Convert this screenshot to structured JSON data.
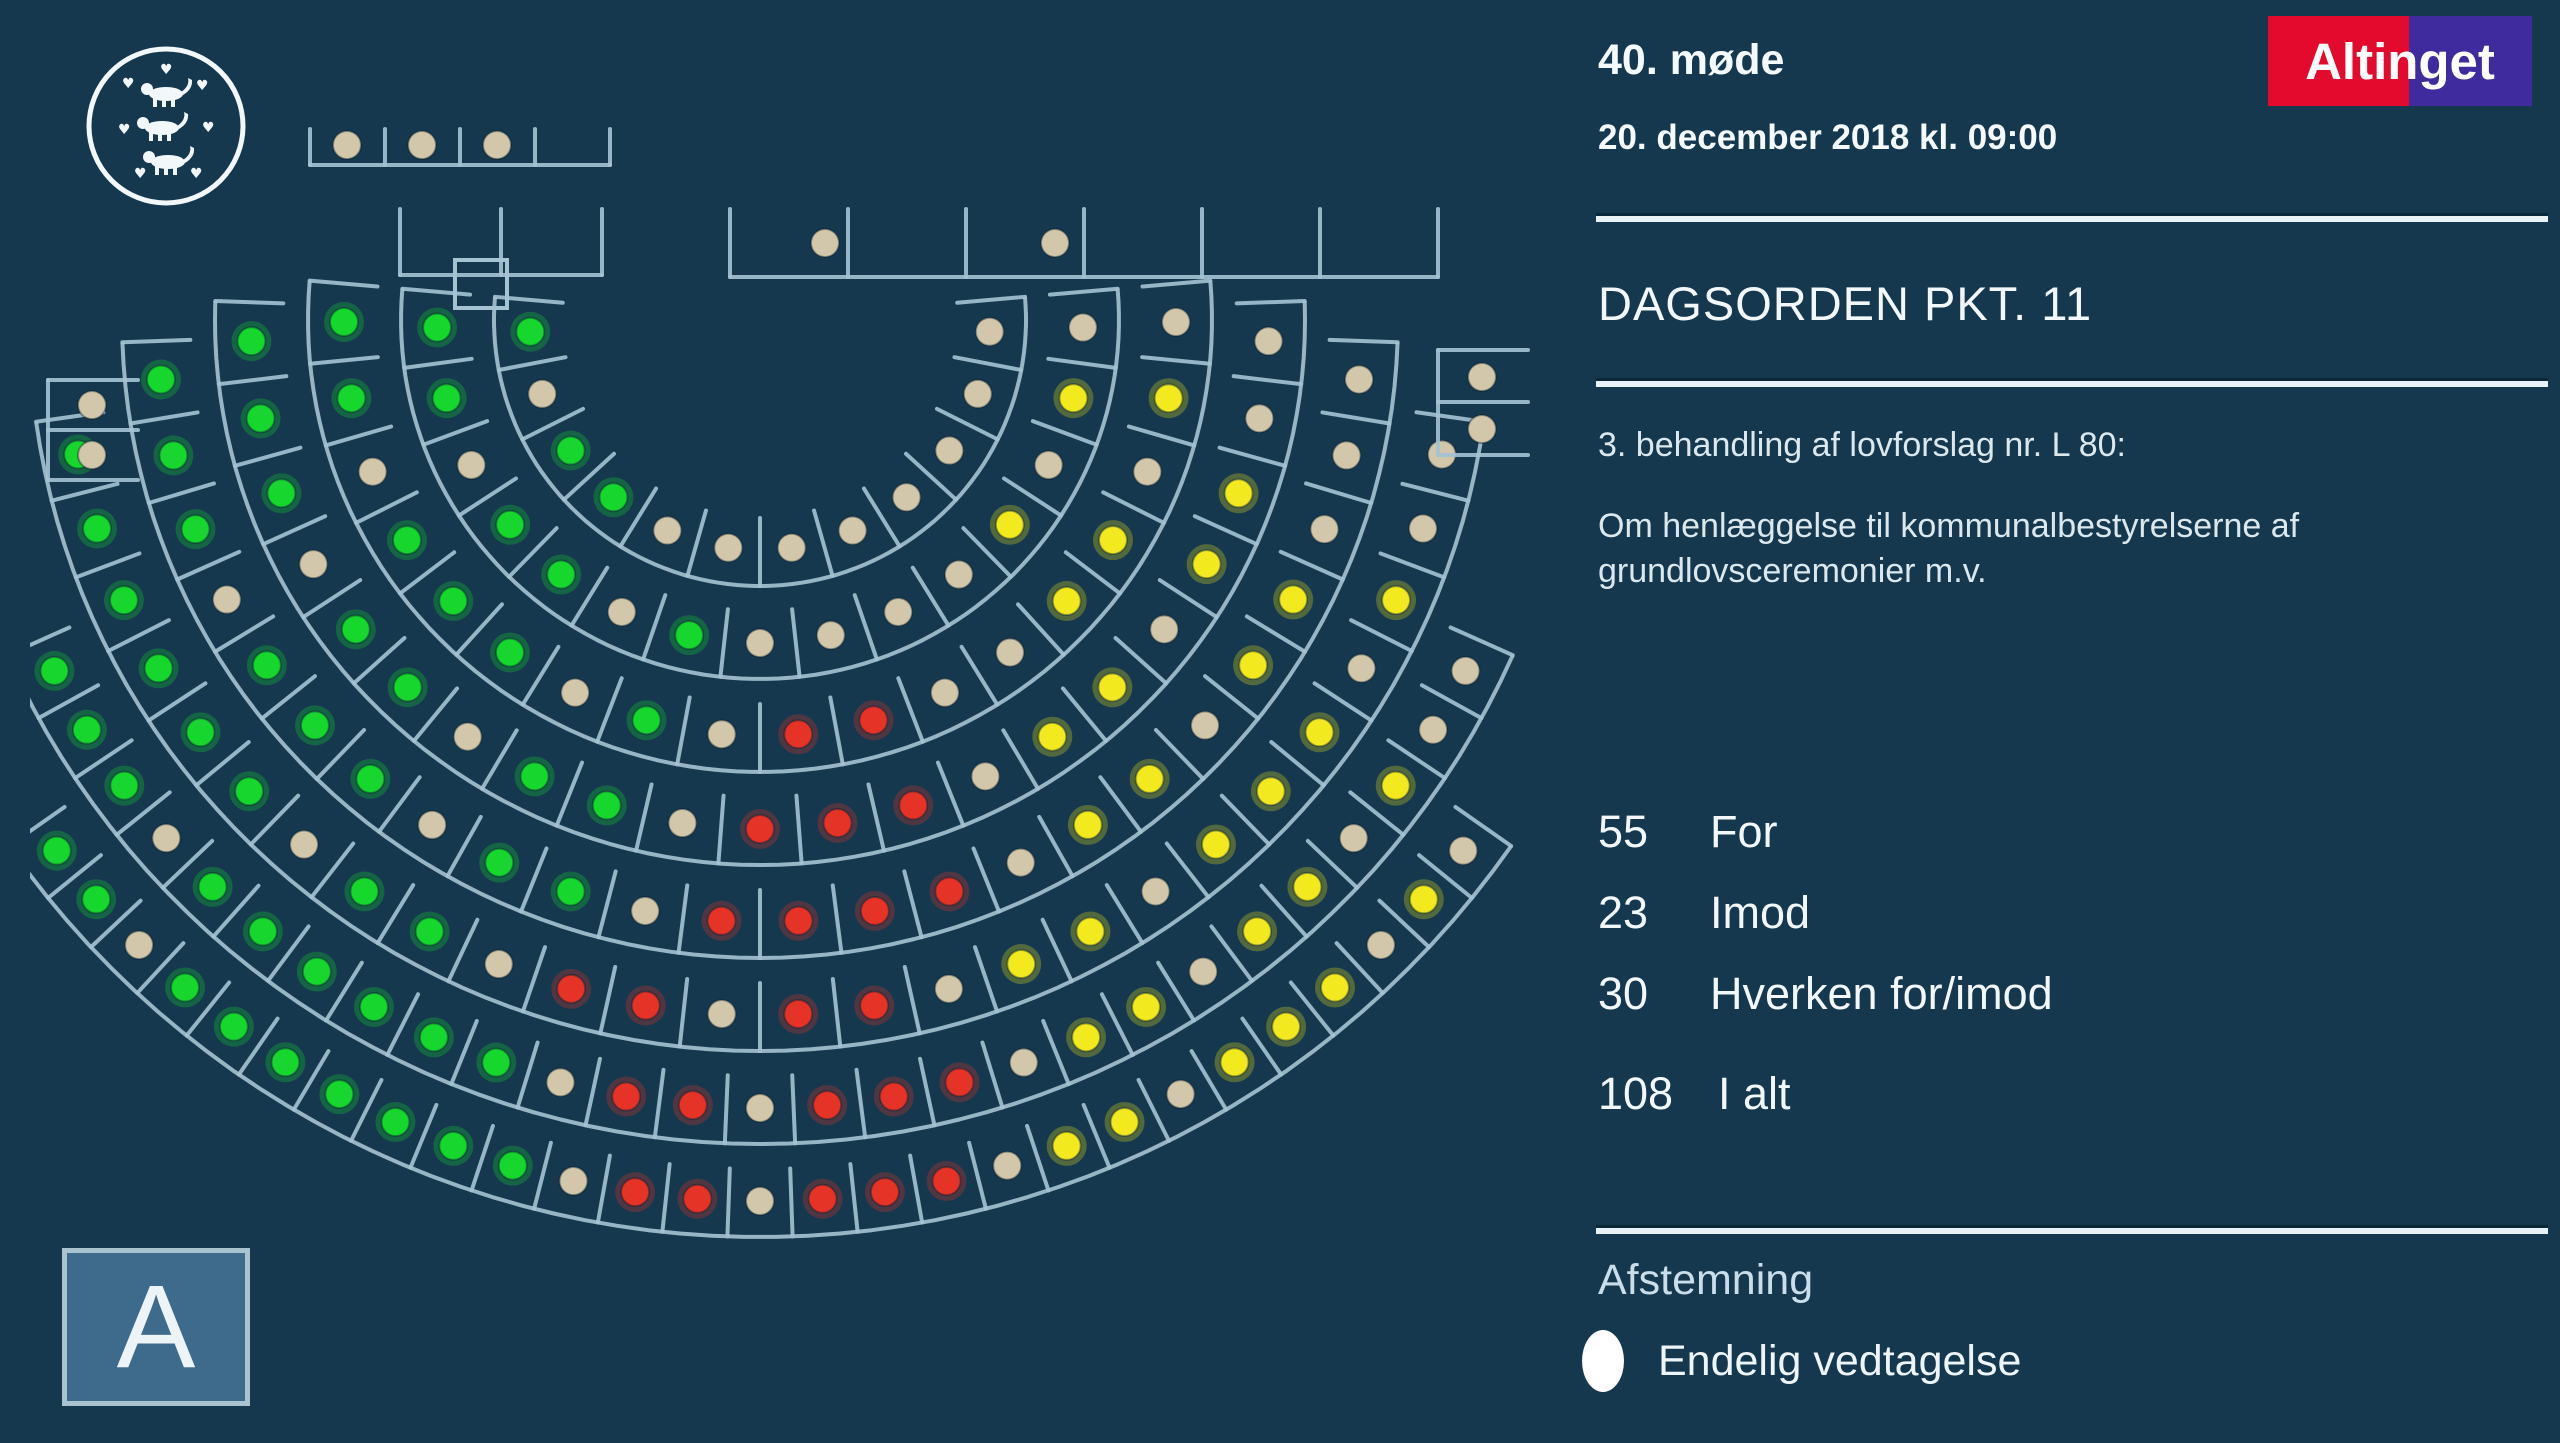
{
  "header": {
    "meeting": "40. møde",
    "datetime": "20. december 2018 kl. 09:00"
  },
  "logo": {
    "text": "Altinget"
  },
  "agenda": {
    "title": "DAGSORDEN PKT. 11",
    "case_line": "3. behandling af lovforslag nr. L 80:",
    "description": "Om henlæggelse til kommunalbestyrelserne af grundlovsceremonier m.v."
  },
  "results": {
    "rows": [
      {
        "value": "55",
        "label": "For"
      },
      {
        "value": "23",
        "label": "Imod"
      },
      {
        "value": "30",
        "label": "Hverken for/imod"
      }
    ],
    "total": {
      "value": "108",
      "label": "I alt"
    }
  },
  "footer": {
    "heading": "Afstemning",
    "bullet_label": "Endelig vedtagelse"
  },
  "party_letter": "A",
  "colors": {
    "background": "#15384e",
    "seat_line": "#a5c3d3",
    "for_green": "#17d62e",
    "against_red": "#e63328",
    "neither_yellow": "#f2ea1e",
    "not_voting_tan": "#d2c7aa",
    "divider": "#e9f2f6",
    "logo_red": "#e40a2d",
    "logo_purple": "#3f2a9e",
    "party_box_fill": "#3e6a8b"
  },
  "chart_data": {
    "type": "hemicycle-seat-map",
    "description": "Folketing chamber seat map; each dot is one member's vote light",
    "legend": {
      "g": "For (green)",
      "r": "Imod (red)",
      "y": "Hverken for/imod (yellow)",
      "t": "Afgav ikke stemme (tan)"
    },
    "votes": {
      "for": 55,
      "imod": 23,
      "hverken_for_imod": 30,
      "i_alt": 108
    },
    "rows": [
      "gtggtttttttt",
      "ggtggtgttttytyt",
      "ggtgggtgtrrttyytyt",
      "gggtggtggtrrrtyytyytt",
      "gggtgggtggtrrrrtyytyyttt",
      "ggggggtggtrrtrrtyytyyytytt",
      "gggtggggggtrrtrrrtyytyytytt",
      "ggtgggggggtrrtrrrtyytyyytyt"
    ],
    "benches": {
      "upper_bench": [
        "t",
        "t",
        "t"
      ],
      "minister_bench": [
        "t",
        "t"
      ],
      "left_box": [
        "t",
        "t"
      ],
      "right_box": [
        "t",
        "t"
      ]
    }
  }
}
